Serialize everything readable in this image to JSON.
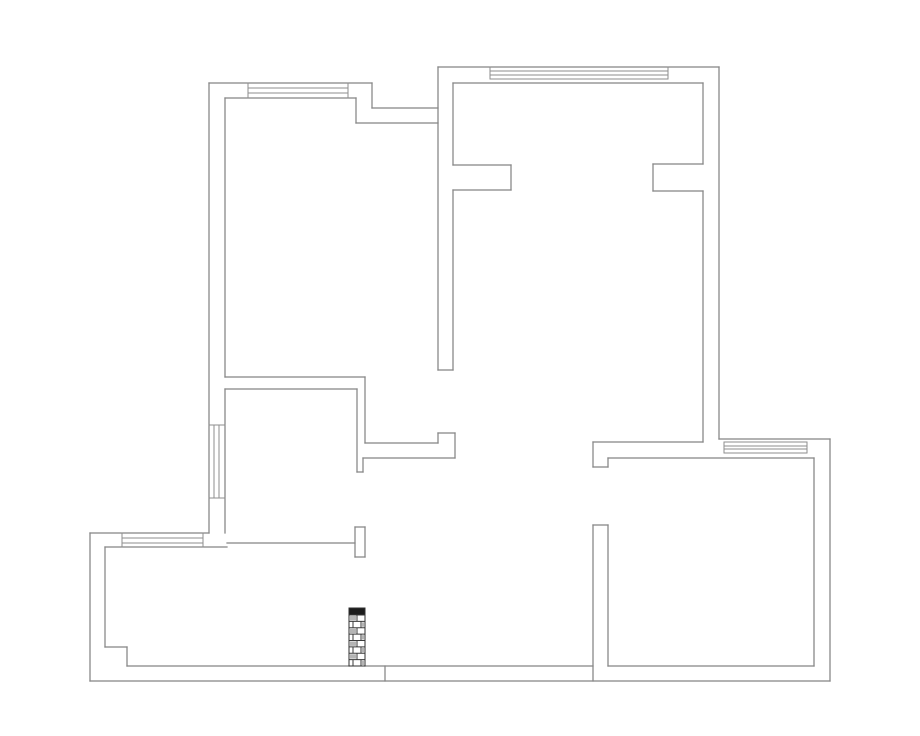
{
  "canvas": {
    "width": 920,
    "height": 736,
    "background": "#ffffff"
  },
  "style": {
    "wall_color": "#858585",
    "wall_stroke_width": 1.25,
    "glazing_color": "#8e8e8e",
    "glazing_stroke_width": 1,
    "brick_outline_color": "#2f2f2f",
    "brick_cap_fill": "#1c1c1c",
    "brick_cell_fill": "#b5b5b5",
    "brick_line_color": "#3a3a3a"
  },
  "walls": [
    [
      209,
      83,
      372,
      83
    ],
    [
      372,
      83,
      372,
      108
    ],
    [
      372,
      108,
      438,
      108
    ],
    [
      438,
      67,
      438,
      370
    ],
    [
      438,
      67,
      719,
      67
    ],
    [
      719,
      67,
      719,
      439
    ],
    [
      719,
      439,
      830,
      439
    ],
    [
      830,
      439,
      830,
      681
    ],
    [
      90,
      681,
      830,
      681
    ],
    [
      90,
      533,
      90,
      681
    ],
    [
      90,
      533,
      209,
      533
    ],
    [
      209,
      83,
      209,
      533
    ],
    [
      225,
      98,
      356,
      98
    ],
    [
      356,
      98,
      356,
      123
    ],
    [
      356,
      123,
      438,
      123
    ],
    [
      225,
      98,
      225,
      377
    ],
    [
      225,
      377,
      365,
      377
    ],
    [
      365,
      377,
      365,
      443
    ],
    [
      225,
      389,
      357,
      389
    ],
    [
      357,
      389,
      357,
      472
    ],
    [
      357,
      472,
      363,
      472
    ],
    [
      363,
      458,
      363,
      472
    ],
    [
      365,
      443,
      438,
      443
    ],
    [
      438,
      433,
      438,
      443
    ],
    [
      438,
      433,
      455,
      433
    ],
    [
      455,
      433,
      455,
      458
    ],
    [
      363,
      458,
      455,
      458
    ],
    [
      453,
      83,
      453,
      165
    ],
    [
      453,
      190,
      453,
      370
    ],
    [
      438,
      370,
      453,
      370
    ],
    [
      453,
      83,
      703,
      83
    ],
    [
      453,
      165,
      511,
      165
    ],
    [
      511,
      165,
      511,
      190
    ],
    [
      453,
      190,
      511,
      190
    ],
    [
      653,
      164,
      703,
      164
    ],
    [
      653,
      164,
      653,
      191
    ],
    [
      653,
      191,
      703,
      191
    ],
    [
      703,
      83,
      703,
      164
    ],
    [
      703,
      191,
      703,
      442
    ],
    [
      593,
      442,
      703,
      442
    ],
    [
      593,
      442,
      593,
      467
    ],
    [
      593,
      467,
      608,
      467
    ],
    [
      608,
      458,
      608,
      467
    ],
    [
      608,
      458,
      814,
      458
    ],
    [
      814,
      458,
      814,
      666
    ],
    [
      608,
      666,
      814,
      666
    ],
    [
      593,
      525,
      608,
      525
    ],
    [
      593,
      525,
      593,
      681
    ],
    [
      608,
      525,
      608,
      666
    ],
    [
      105,
      547,
      105,
      647
    ],
    [
      105,
      647,
      127,
      647
    ],
    [
      127,
      647,
      127,
      666
    ],
    [
      127,
      666,
      349,
      666
    ],
    [
      365,
      666,
      593,
      666
    ],
    [
      385,
      666,
      385,
      681
    ],
    [
      105,
      547,
      227,
      547
    ],
    [
      225,
      389,
      225,
      533
    ],
    [
      227,
      543,
      355,
      543
    ],
    [
      355,
      527,
      365,
      527
    ],
    [
      355,
      527,
      355,
      557
    ],
    [
      365,
      527,
      365,
      557
    ],
    [
      355,
      557,
      365,
      557
    ]
  ],
  "window_glazing": [
    [
      248,
      88,
      348,
      88
    ],
    [
      248,
      93,
      348,
      93
    ],
    [
      490,
      71,
      668,
      71
    ],
    [
      490,
      75,
      668,
      75
    ],
    [
      490,
      79,
      668,
      79
    ],
    [
      214,
      425,
      214,
      498
    ],
    [
      219,
      425,
      219,
      498
    ],
    [
      122,
      538,
      203,
      538
    ],
    [
      122,
      543,
      203,
      543
    ],
    [
      724,
      442,
      807,
      442
    ],
    [
      724,
      446,
      807,
      446
    ],
    [
      724,
      449,
      807,
      449
    ],
    [
      724,
      453,
      807,
      453
    ]
  ],
  "window_ticks": [
    [
      248,
      83,
      248,
      98
    ],
    [
      348,
      83,
      348,
      98
    ],
    [
      490,
      67,
      490,
      79
    ],
    [
      668,
      67,
      668,
      79
    ],
    [
      209,
      425,
      225,
      425
    ],
    [
      209,
      498,
      225,
      498
    ],
    [
      122,
      533,
      122,
      547
    ],
    [
      203,
      533,
      203,
      547
    ],
    [
      724,
      442,
      724,
      453
    ],
    [
      807,
      442,
      807,
      453
    ]
  ],
  "brick_column": {
    "x": 349,
    "y": 608,
    "width": 16,
    "height": 58,
    "cap_height": 7,
    "courses": 8
  }
}
